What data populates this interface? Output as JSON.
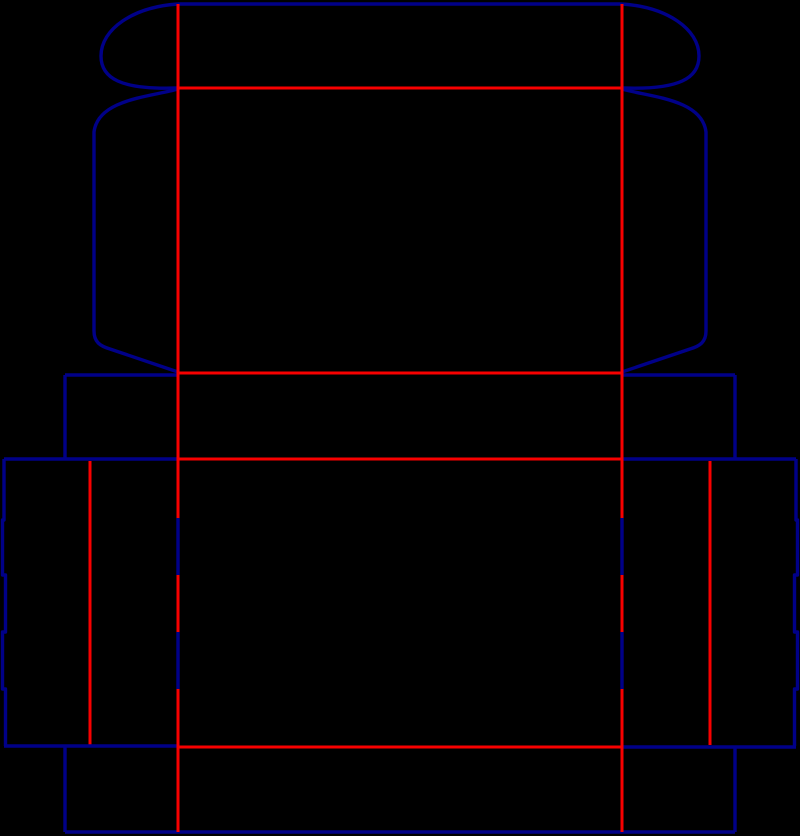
{
  "page": {
    "width": 800,
    "height": 836,
    "background": "#000000"
  },
  "dieline": {
    "colors": {
      "cut_blue": "#000088",
      "crease_red": "#f80000"
    },
    "stroke_widths": {
      "cut_blue": 3.4,
      "crease_red": 3
    },
    "shapes": [
      {
        "name": "tuck-flap-top-edge-cut",
        "color": "cut_blue",
        "d": "M 178 4 L 622 4"
      },
      {
        "name": "tuck-flap-left-ear-cut",
        "color": "cut_blue",
        "d": "M 178 4 C 133 7 101 29 101 56 C 101 78 120 90 178 88"
      },
      {
        "name": "tuck-flap-right-ear-cut",
        "color": "cut_blue",
        "d": "M 622 4 C 667 7 699 29 699 56 C 699 78 680 90 622 88"
      },
      {
        "name": "tuck-flap-fold-crease",
        "color": "crease_red",
        "d": "M 178 88 L 622 88"
      },
      {
        "name": "lid-left-side-flap-cut",
        "color": "cut_blue",
        "d": "M 178 89 C 150 97 98 99 94 132 L 94 331 C 94 342 100 346 110 349 L 178 372"
      },
      {
        "name": "lid-right-side-flap-cut",
        "color": "cut_blue",
        "d": "M 622 89 C 650 97 702 99 706 132 L 706 331 C 706 342 700 346 690 349 L 622 372"
      },
      {
        "name": "lid-front-fold-crease",
        "color": "crease_red",
        "d": "M 178 373 L 622 373"
      },
      {
        "name": "lid-front-tab-top-left-cut",
        "color": "cut_blue",
        "d": "M 65 375 L 178 375"
      },
      {
        "name": "lid-front-tab-top-right-cut",
        "color": "cut_blue",
        "d": "M 622 375 L 735 375"
      },
      {
        "name": "lid-front-tab-left-edge-cut",
        "color": "cut_blue",
        "d": "M 65 375 L 65 459"
      },
      {
        "name": "lid-front-tab-right-edge-cut",
        "color": "cut_blue",
        "d": "M 735 375 L 735 459"
      },
      {
        "name": "body-top-left-cut",
        "color": "cut_blue",
        "d": "M 4 459 L 178 459"
      },
      {
        "name": "body-top-fold-crease",
        "color": "crease_red",
        "d": "M 178 459 L 622 459"
      },
      {
        "name": "body-top-right-cut",
        "color": "cut_blue",
        "d": "M 622 459 L 796 459"
      },
      {
        "name": "left-dust-flap-crease",
        "color": "crease_red",
        "d": "M 90 461 L 90 745"
      },
      {
        "name": "right-dust-flap-crease",
        "color": "crease_red",
        "d": "M 710 461 L 710 745"
      },
      {
        "name": "left-notched-edge-cut",
        "color": "cut_blue",
        "d": "M 4 459 L 4 520 L 2.5 520 L 2.5 575 L 5.5 575 L 5.5 632 L 2.5 632 L 2.5 689 L 5.5 689 L 5.5 746"
      },
      {
        "name": "right-notched-edge-cut",
        "color": "cut_blue",
        "d": "M 796 459 L 796 520 L 797.5 520 L 797.5 575 L 794.5 575 L 794.5 632 L 797.5 632 L 797.5 689 L 794.5 689 L 794.5 746"
      },
      {
        "name": "body-bottom-left-cut",
        "color": "cut_blue",
        "d": "M 4 746 L 178 746"
      },
      {
        "name": "body-bottom-fold-crease",
        "color": "crease_red",
        "d": "M 178 747 L 622 747"
      },
      {
        "name": "body-bottom-right-cut",
        "color": "cut_blue",
        "d": "M 622 747 L 796 747"
      },
      {
        "name": "bottom-flap-left-edge-cut",
        "color": "cut_blue",
        "d": "M 65 747 L 65 832"
      },
      {
        "name": "bottom-flap-right-edge-cut",
        "color": "cut_blue",
        "d": "M 735 747 L 735 832"
      },
      {
        "name": "bottom-flap-bottom-edge-cut",
        "color": "cut_blue",
        "d": "M 65 832 L 735 832"
      },
      {
        "name": "front-left-crease-upper",
        "color": "crease_red",
        "d": "M 178 4 L 178 518"
      },
      {
        "name": "front-left-cut-slit-1",
        "color": "cut_blue",
        "d": "M 178 518 L 178 575"
      },
      {
        "name": "front-left-crease-middle",
        "color": "crease_red",
        "d": "M 178 575 L 178 632"
      },
      {
        "name": "front-left-cut-slit-2",
        "color": "cut_blue",
        "d": "M 178 632 L 178 689"
      },
      {
        "name": "front-left-crease-lower",
        "color": "crease_red",
        "d": "M 178 689 L 178 832"
      },
      {
        "name": "front-right-crease-upper",
        "color": "crease_red",
        "d": "M 622 4 L 622 518"
      },
      {
        "name": "front-right-cut-slit-1",
        "color": "cut_blue",
        "d": "M 622 518 L 622 575"
      },
      {
        "name": "front-right-crease-middle",
        "color": "crease_red",
        "d": "M 622 575 L 622 632"
      },
      {
        "name": "front-right-cut-slit-2",
        "color": "cut_blue",
        "d": "M 622 632 L 622 689"
      },
      {
        "name": "front-right-crease-lower",
        "color": "crease_red",
        "d": "M 622 689 L 622 832"
      }
    ]
  }
}
